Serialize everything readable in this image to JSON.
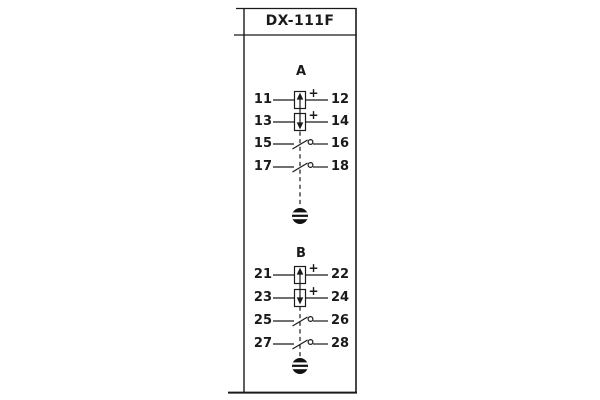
{
  "title": "DX-111F",
  "colors": {
    "line": "#1a1a1a",
    "background": "#ffffff",
    "button_fill": "#111111"
  },
  "plus_sign": "+",
  "groups": [
    {
      "label": "A",
      "rows": [
        {
          "left": "11",
          "right": "12",
          "symbol": "polarized-coil-up-icon",
          "polarity": "+"
        },
        {
          "left": "13",
          "right": "14",
          "symbol": "polarized-coil-down-icon",
          "polarity": "+"
        },
        {
          "left": "15",
          "right": "16",
          "symbol": "no-contact-icon"
        },
        {
          "left": "17",
          "right": "18",
          "symbol": "no-contact-icon"
        }
      ],
      "reset_button": "reset-button-icon"
    },
    {
      "label": "B",
      "rows": [
        {
          "left": "21",
          "right": "22",
          "symbol": "polarized-coil-up-icon",
          "polarity": "+"
        },
        {
          "left": "23",
          "right": "24",
          "symbol": "polarized-coil-down-icon",
          "polarity": "+"
        },
        {
          "left": "25",
          "right": "26",
          "symbol": "no-contact-icon"
        },
        {
          "left": "27",
          "right": "28",
          "symbol": "no-contact-icon"
        }
      ],
      "reset_button": "reset-button-icon"
    }
  ]
}
